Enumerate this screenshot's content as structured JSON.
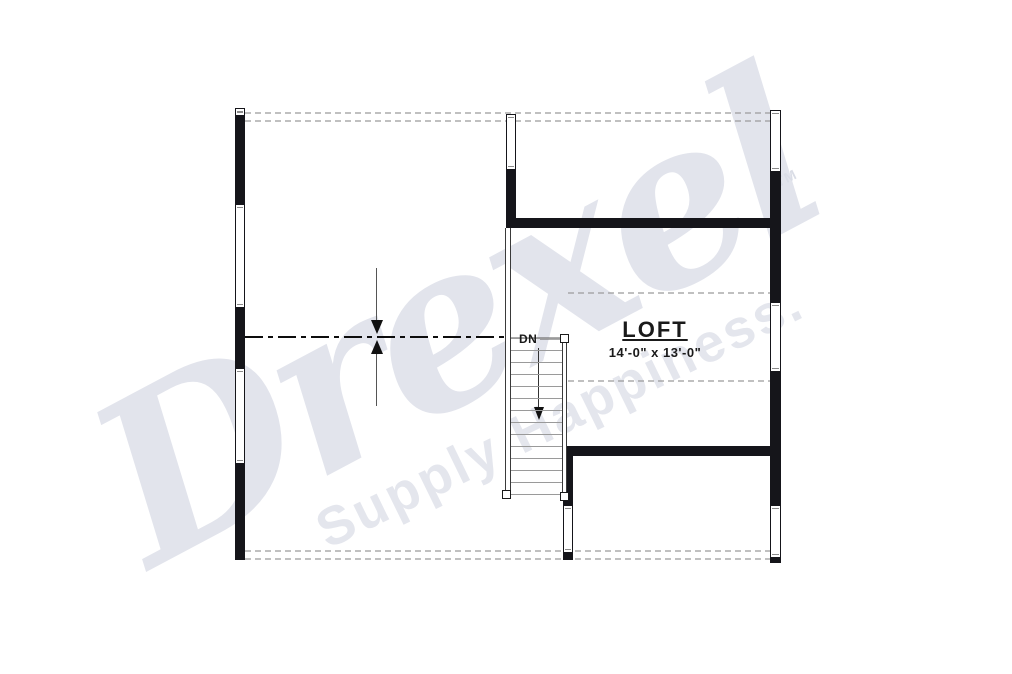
{
  "watermark": {
    "brand": "Drexel",
    "tagline": "Supply Happiness.",
    "trademark_symbol": "TM",
    "color": "#e2e4ec"
  },
  "plan": {
    "room": {
      "name": "LOFT",
      "size": "14'-0\" x 13'-0\""
    },
    "stairs": {
      "direction_label": "DN"
    }
  },
  "colors": {
    "paper": "#ffffff",
    "wall": "#15151a",
    "dashed_ceiling_line": "#9b9b9b",
    "centerline": "#0d0d0d",
    "tread_line": "#9a9a9a"
  }
}
